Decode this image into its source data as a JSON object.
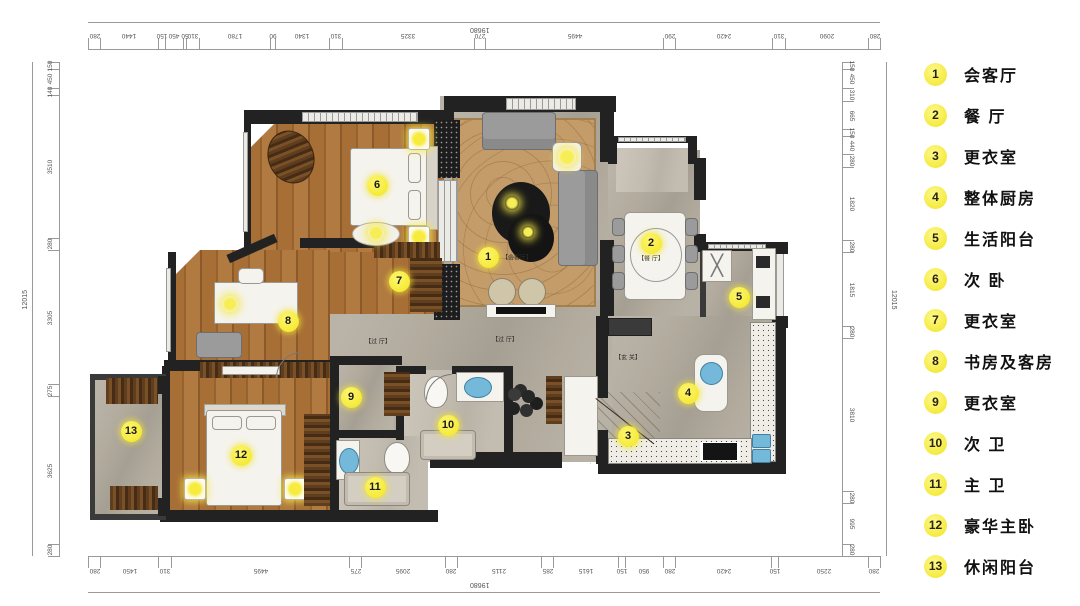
{
  "legend": {
    "items": [
      {
        "num": "1",
        "label": "会客厅"
      },
      {
        "num": "2",
        "label": "餐 厅"
      },
      {
        "num": "3",
        "label": "更衣室"
      },
      {
        "num": "4",
        "label": "整体厨房"
      },
      {
        "num": "5",
        "label": "生活阳台"
      },
      {
        "num": "6",
        "label": "次 卧"
      },
      {
        "num": "7",
        "label": "更衣室"
      },
      {
        "num": "8",
        "label": "书房及客房"
      },
      {
        "num": "9",
        "label": "更衣室"
      },
      {
        "num": "10",
        "label": "次 卫"
      },
      {
        "num": "11",
        "label": "主 卫"
      },
      {
        "num": "12",
        "label": "豪华主卧"
      },
      {
        "num": "13",
        "label": "休闲阳台"
      }
    ]
  },
  "plan": {
    "markers": [
      {
        "num": "1",
        "x": 488,
        "y": 257
      },
      {
        "num": "2",
        "x": 651,
        "y": 243
      },
      {
        "num": "3",
        "x": 628,
        "y": 436
      },
      {
        "num": "4",
        "x": 688,
        "y": 393
      },
      {
        "num": "5",
        "x": 739,
        "y": 297
      },
      {
        "num": "6",
        "x": 377,
        "y": 185
      },
      {
        "num": "7",
        "x": 399,
        "y": 281
      },
      {
        "num": "8",
        "x": 288,
        "y": 321
      },
      {
        "num": "9",
        "x": 351,
        "y": 397
      },
      {
        "num": "10",
        "x": 448,
        "y": 425
      },
      {
        "num": "11",
        "x": 375,
        "y": 487
      },
      {
        "num": "12",
        "x": 241,
        "y": 455
      },
      {
        "num": "13",
        "x": 131,
        "y": 431
      }
    ],
    "room_labels": [
      {
        "text": "【会客厅】",
        "x": 517,
        "y": 257
      },
      {
        "text": "【餐 厅】",
        "x": 651,
        "y": 258
      },
      {
        "text": "【过 厅】",
        "x": 378,
        "y": 341
      },
      {
        "text": "【过 厅】",
        "x": 505,
        "y": 339
      },
      {
        "text": "【玄 关】",
        "x": 628,
        "y": 357
      }
    ]
  },
  "dimensions": {
    "top": {
      "total": "19680",
      "segments": [
        "280",
        "1440",
        "150",
        "450",
        "50",
        "310",
        "1780",
        "90",
        "1340",
        "310",
        "3325",
        "270",
        "4495",
        "290",
        "2420",
        "310",
        "2090",
        "280"
      ]
    },
    "bottom": {
      "total": "19680",
      "segments": [
        "280",
        "1450",
        "310",
        "4495",
        "275",
        "2095",
        "280",
        "2115",
        "285",
        "1615",
        "150",
        "950",
        "280",
        "2420",
        "150",
        "2250",
        "280"
      ]
    },
    "left": {
      "total": "12015",
      "segments": [
        "150",
        "450",
        "140",
        "3510",
        "280",
        "3305",
        "275",
        "3625",
        "280"
      ]
    },
    "right": {
      "total": "12015",
      "segments": [
        "150",
        "450",
        "310",
        "665",
        "150",
        "440",
        "280",
        "1820",
        "280",
        "1815",
        "280",
        "3810",
        "280",
        "995",
        "280"
      ]
    }
  },
  "colors": {
    "marker_yellow": "#f2e520",
    "wall": "#222222",
    "wood_floor": "#a76f36",
    "tile_floor": "#b2ab9e",
    "rug": "#c49c69"
  }
}
